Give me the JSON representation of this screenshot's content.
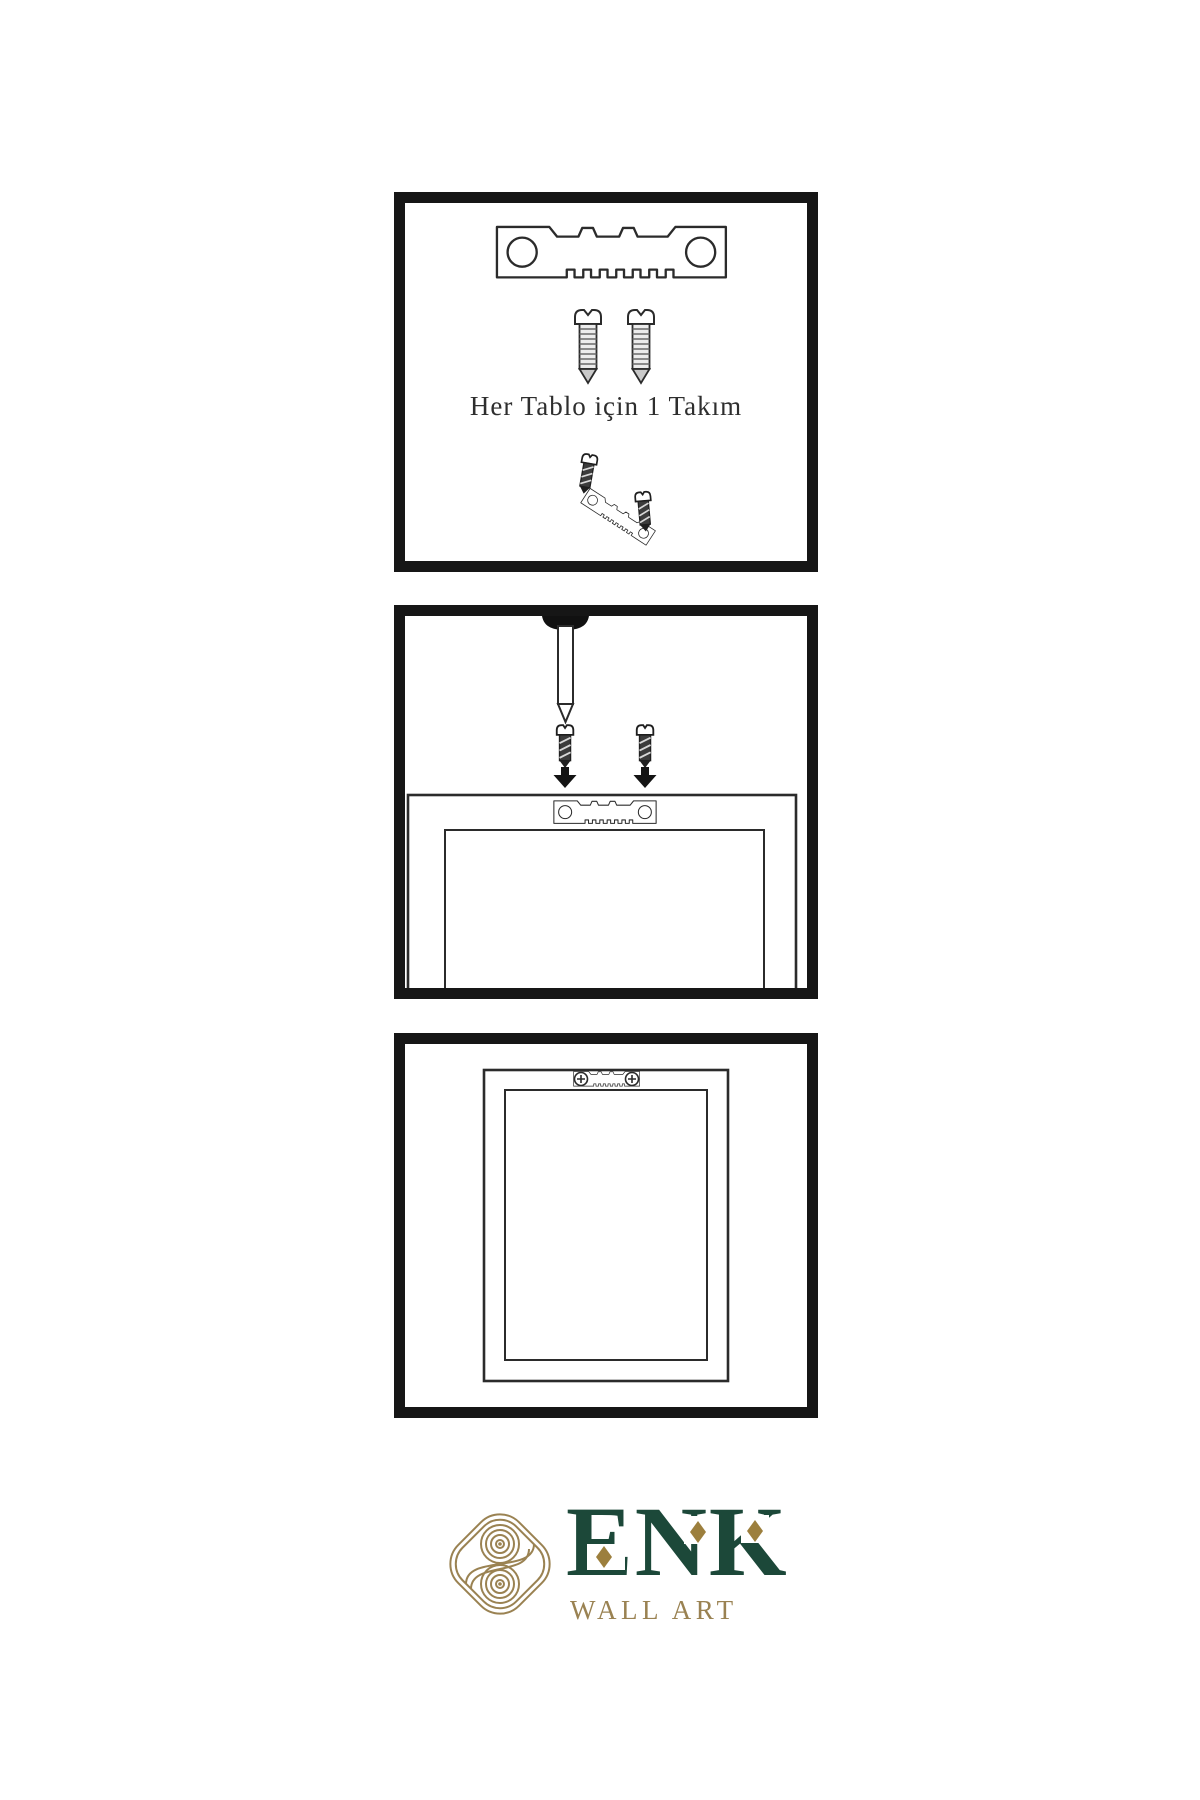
{
  "page": {
    "background": "#ffffff",
    "kind": "wall-art-hanging-instruction-sheet"
  },
  "colors": {
    "panel_border": "#161616",
    "line_art": "#2b2b2b",
    "metal_dark": "#3c3c3c",
    "brand_green": "#1c4839",
    "brand_gold": "#9a8252",
    "diamond_gold": "#9c7f3d",
    "caption_text": "#2e2e2e"
  },
  "steps": [
    {
      "caption": "Her Tablo için 1 Takım",
      "items": [
        "sawtooth-hanger-icon",
        "screw-icon",
        "screw-icon",
        "screw-into-hanger-assembly-icon"
      ]
    },
    {
      "caption": "",
      "items": [
        "wall-nail-icon",
        "screw-icon",
        "screw-icon",
        "down-arrow-icon",
        "down-arrow-icon",
        "frame-back-with-sawtooth-hanger"
      ]
    },
    {
      "caption": "",
      "items": [
        "hanging-frame-with-mounted-hanger"
      ]
    }
  ],
  "brand": {
    "name": "ENK",
    "subtitle": "WALL ART",
    "icon": "interlaced-knot-icon"
  }
}
